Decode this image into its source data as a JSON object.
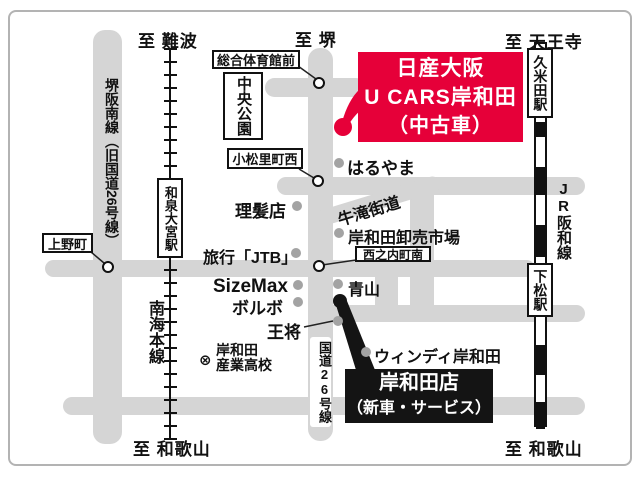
{
  "direction_labels": {
    "namba": "至 難波",
    "sakai": "至 堺",
    "tennoji": "至 天王寺",
    "wakayama_left": "至 和歌山",
    "wakayama_right": "至 和歌山"
  },
  "roads": {
    "sakaihannan_label": "堺阪南線（旧国道26号線）",
    "route26_label": "国道26号線",
    "ushitaki_label": "牛滝街道"
  },
  "railways": {
    "nankai_label": "南海本線",
    "jr_label": "JR阪和線"
  },
  "stations": {
    "izumiomiya": "和泉大宮駅",
    "kumeda": "久米田駅",
    "shimomatsu": "下松駅"
  },
  "intersection_labels": {
    "sogotaiikukan": "総合体育館前",
    "chuokoen": "中央公園",
    "komatsuri": "小松里町西",
    "ueno": "上野町",
    "nishinouchi": "西之内町南"
  },
  "pois": {
    "haruyama": "はるやま",
    "barber": "理髪店",
    "oroshiuri": "岸和田卸売市場",
    "jtb": "旅行「JTB」",
    "sizemax": "SizeMax",
    "volvo": "ボルボ",
    "aoyama": "青山",
    "osho": "王将",
    "windy": "ウィンディ岸和田",
    "school_symbol": "⊗",
    "school_line1": "岸和田",
    "school_line2": "産業高校"
  },
  "ucars_box": {
    "line1": "日産大阪",
    "line2": "U CARS岸和田",
    "line3": "（中古車）",
    "bg_color": "#e60039"
  },
  "main_store_box": {
    "line1": "岸和田店",
    "line2": "（新車・サービス）",
    "bg_color": "#141414"
  },
  "colors": {
    "road": "#d5d5d5",
    "gray_dot": "#a3a3a3",
    "red": "#e60039"
  }
}
